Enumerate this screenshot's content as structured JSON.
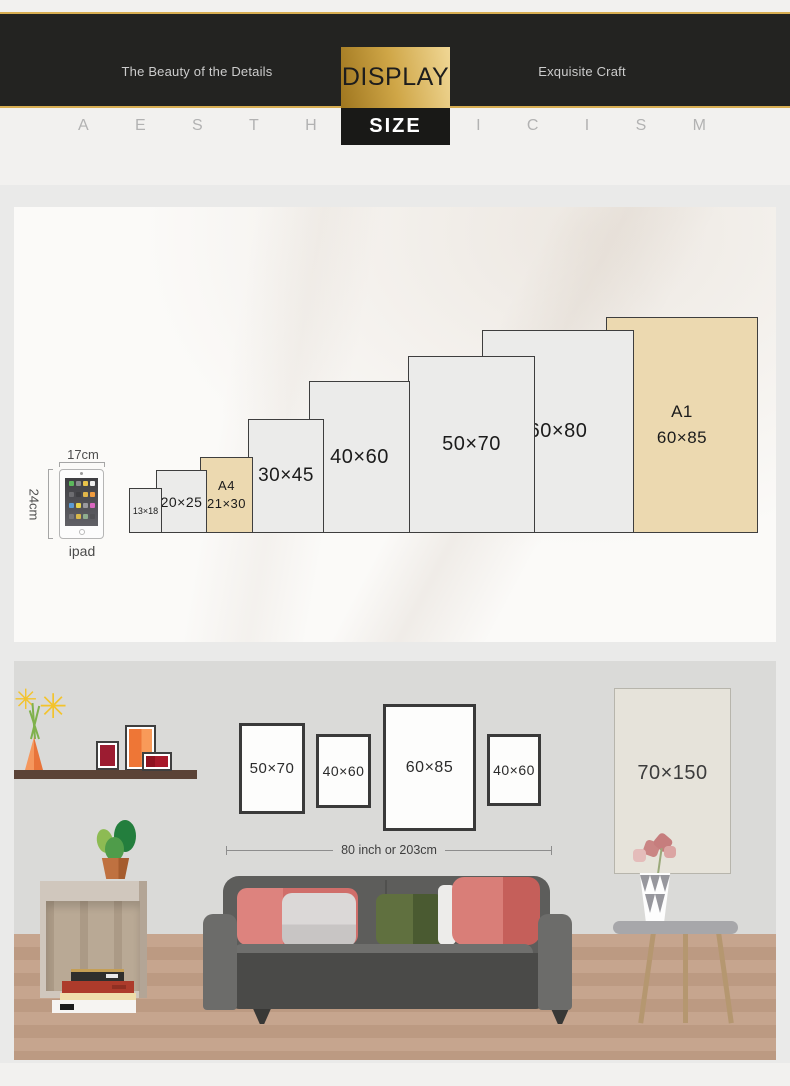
{
  "header": {
    "tagline_left": "The Beauty of the Details",
    "badge_primary": "DISPLAY",
    "badge_secondary": "SIZE",
    "tagline_right": "Exquisite Craft",
    "letters": [
      "A",
      "E",
      "S",
      "T",
      "H",
      "E",
      "T",
      "I",
      "C",
      "I",
      "S",
      "M"
    ],
    "colors": {
      "gold": "#cfa647",
      "band": "#232321"
    }
  },
  "size_chart": {
    "ipad": {
      "width_label": "17cm",
      "height_label": "24cm",
      "caption": "ipad"
    },
    "boxes": [
      {
        "line1": "13×18",
        "w_cm": 13,
        "h_cm": 18,
        "accent": false
      },
      {
        "line1": "20×25",
        "w_cm": 20,
        "h_cm": 25,
        "accent": false
      },
      {
        "line1": "A4",
        "line2": "21×30",
        "w_cm": 21,
        "h_cm": 30,
        "accent": true
      },
      {
        "line1": "30×45",
        "w_cm": 30,
        "h_cm": 45,
        "accent": false
      },
      {
        "line1": "40×60",
        "w_cm": 40,
        "h_cm": 60,
        "accent": false
      },
      {
        "line1": "50×70",
        "w_cm": 50,
        "h_cm": 70,
        "accent": false
      },
      {
        "line1": "60×80",
        "w_cm": 60,
        "h_cm": 80,
        "accent": false
      },
      {
        "line1": "A1",
        "line2": "60×85",
        "w_cm": 60,
        "h_cm": 85,
        "accent": true
      }
    ],
    "colors": {
      "box_fill": "#ebebea",
      "accent_fill": "#ecd9b0",
      "border": "#3e3e3e"
    }
  },
  "room": {
    "wall_frames": [
      {
        "label": "50×70"
      },
      {
        "label": "40×60"
      },
      {
        "label": "60×85"
      },
      {
        "label": "40×60"
      },
      {
        "label": "70×150"
      }
    ],
    "sofa_width_label": "80 inch or 203cm",
    "colors": {
      "wall": "#dadad8",
      "floor": "#c3a28b",
      "sofa": "#5d5d5b"
    }
  }
}
